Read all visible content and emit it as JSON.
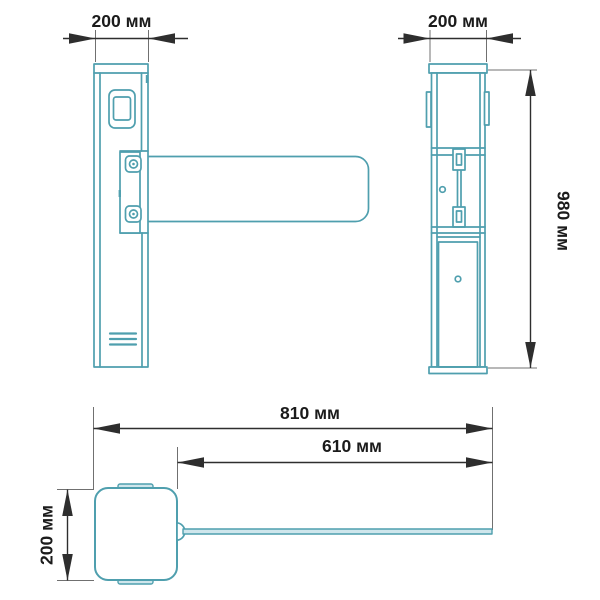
{
  "colors": {
    "outline": "#4f9fae",
    "fill-light": "#cfe6ec",
    "dim-line": "#2e2e2e",
    "ext-line": "#707070",
    "label": "#1b1b1b",
    "background": "#ffffff"
  },
  "labels": {
    "front_width": "200 мм",
    "side_width": "200 мм",
    "height": "980 мм",
    "overall_length": "810 мм",
    "arm_length": "610 мм",
    "depth": "200 мм"
  }
}
